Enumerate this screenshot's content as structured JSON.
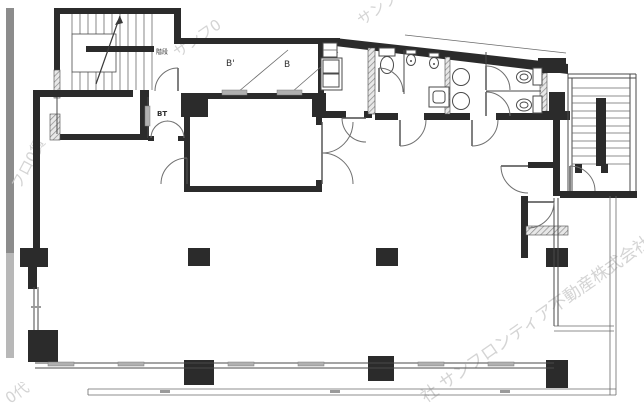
{
  "plan": {
    "labels": {
      "stairwell": "階段",
      "room_b_prime": "B'",
      "room_b": "B",
      "entry_vestibule": "BT"
    },
    "watermarks": {
      "left_edge": "フロ0賃",
      "top_center": "サンフ0",
      "top_right": "サンフロ",
      "bottom_left": "0代",
      "bottom_right": "社 サンフロンティア不動産株式会社"
    },
    "colors": {
      "wall": "#2b2b2b",
      "line": "#4a4a4a",
      "hatch": "#9a9a9a",
      "slider": "#b0b0b0",
      "watermark": "#cdcdcd",
      "scan_strip_dark": "#8c8c8c",
      "scan_strip_light": "#b8b8b8",
      "background": "#ffffff"
    }
  }
}
